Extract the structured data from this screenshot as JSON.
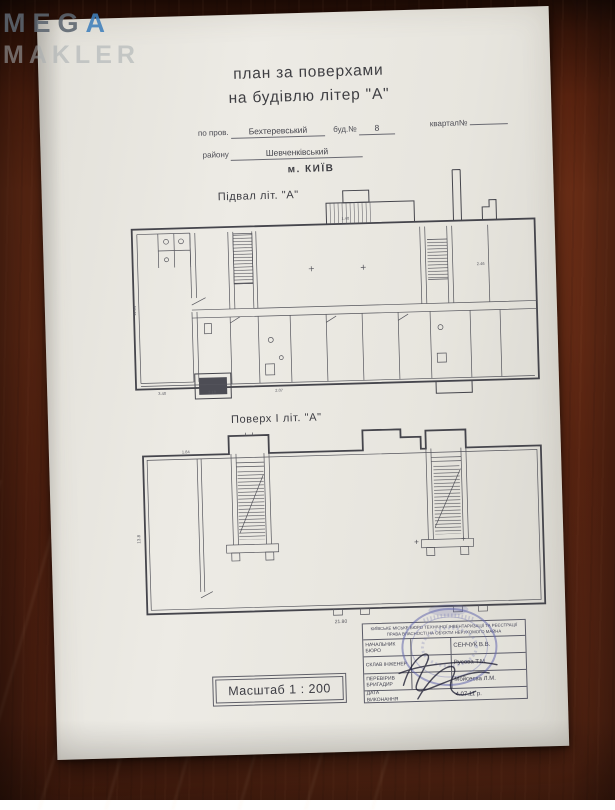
{
  "watermark": {
    "line1_prefix": "MEG",
    "line1_accent": "A",
    "line2": "MAKLER"
  },
  "title": {
    "line1": "план за поверхами",
    "line2": "на будівлю літер \"А\""
  },
  "form": {
    "street_label": "по пров.",
    "street_value": "Бехтеревський",
    "building_label": "буд.№",
    "building_value": "8",
    "quarter_label": "квартал№",
    "district_label": "району",
    "district_value": "Шевченківський",
    "city": "м. КИЇВ"
  },
  "plans": {
    "basement": {
      "label": "Підвал літ. \"А\"",
      "dims": {
        "d1": "3.40",
        "d2": "2.10",
        "d3": "2.07",
        "d4": "2.46",
        "d5": "1.40",
        "d6": "11.64"
      }
    },
    "floor1": {
      "label": "Поверх І літ. \"А\"",
      "dims": {
        "bottom": "21.80",
        "left": "13.8",
        "topleft": "1.84"
      }
    }
  },
  "scale": {
    "text": "Масштаб 1 : 200"
  },
  "signature_table": {
    "org_header": "КИЇВСЬКЕ МІСЬКЕ БЮРО ТЕХНІЧНОЇ ІНВЕНТАРИЗАЦІЇ ТА РЕЄСТРАЦІЇ ПРАВА ВЛАСНОСТІ НА ОБ'ЄКТИ НЕРУХОМОГО МАЙНА",
    "rows": [
      {
        "label": "НАЧАЛЬНИК БЮРО",
        "value": "СЕНЧУК В.В."
      },
      {
        "label": "СКЛАВ ІНЖЕНЕР",
        "value": "Русова Т.М."
      },
      {
        "label": "ПЕРЕВІРИВ БРИГАДИР",
        "value": "Мойсеєва Л.М."
      },
      {
        "label": "ДАТА ВИКОНАННЯ",
        "value": "4.07.11 р."
      }
    ]
  }
}
